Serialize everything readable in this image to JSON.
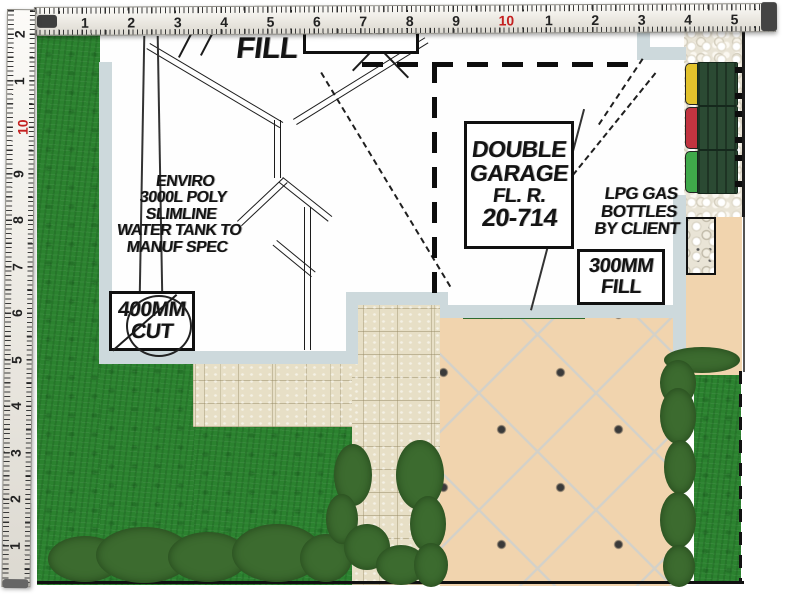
{
  "scene": {
    "type": "landscape-design-site-plan"
  },
  "rulers": {
    "top": {
      "unit_numbers": [
        "1",
        "2",
        "3",
        "4",
        "5",
        "6",
        "7",
        "8",
        "9",
        "10",
        "1",
        "2",
        "3",
        "4",
        "5"
      ],
      "red_index": 9
    },
    "left": {
      "unit_numbers": [
        "2",
        "1",
        "10",
        "9",
        "8",
        "7",
        "6",
        "5",
        "4",
        "3",
        "2",
        "1"
      ],
      "red_index": 2
    }
  },
  "plan": {
    "annotations": {
      "fill": "FILL",
      "water_tank": {
        "lines": [
          "ENVIRO",
          "3000L POLY",
          "SLIMLINE",
          "WATER TANK TO",
          "MANUF SPEC"
        ]
      },
      "cut_box": {
        "lines": [
          "400MM",
          "CUT"
        ]
      },
      "garage_box": {
        "lines": [
          "DOUBLE",
          "GARAGE",
          "FL. R.",
          "20-714"
        ]
      },
      "lpg": {
        "lines": [
          "LPG GAS",
          "BOTTLES",
          "BY CLIENT"
        ]
      },
      "fill_box": {
        "lines": [
          "300MM",
          "FILL"
        ]
      },
      "clipped_top_box": {
        "text": "GB MEZZO 41.9"
      }
    }
  },
  "bins": [
    {
      "name": "bin-yellow-lid",
      "lid_color": "#e2c22c"
    },
    {
      "name": "bin-red-lid",
      "lid_color": "#c23440"
    },
    {
      "name": "bin-green-lid",
      "lid_color": "#3fa94a"
    }
  ],
  "colors": {
    "grass": "#2b822f",
    "paving_tan": "#f1d4ae",
    "stone_pavers": "#e7dfc6",
    "pebbles": "#e9e4d6",
    "house_wall": "#cdd9dc",
    "flower_pink": "#f2aebe",
    "ruler_red": "#c42020",
    "plan_ink": "#1c1c1c"
  }
}
